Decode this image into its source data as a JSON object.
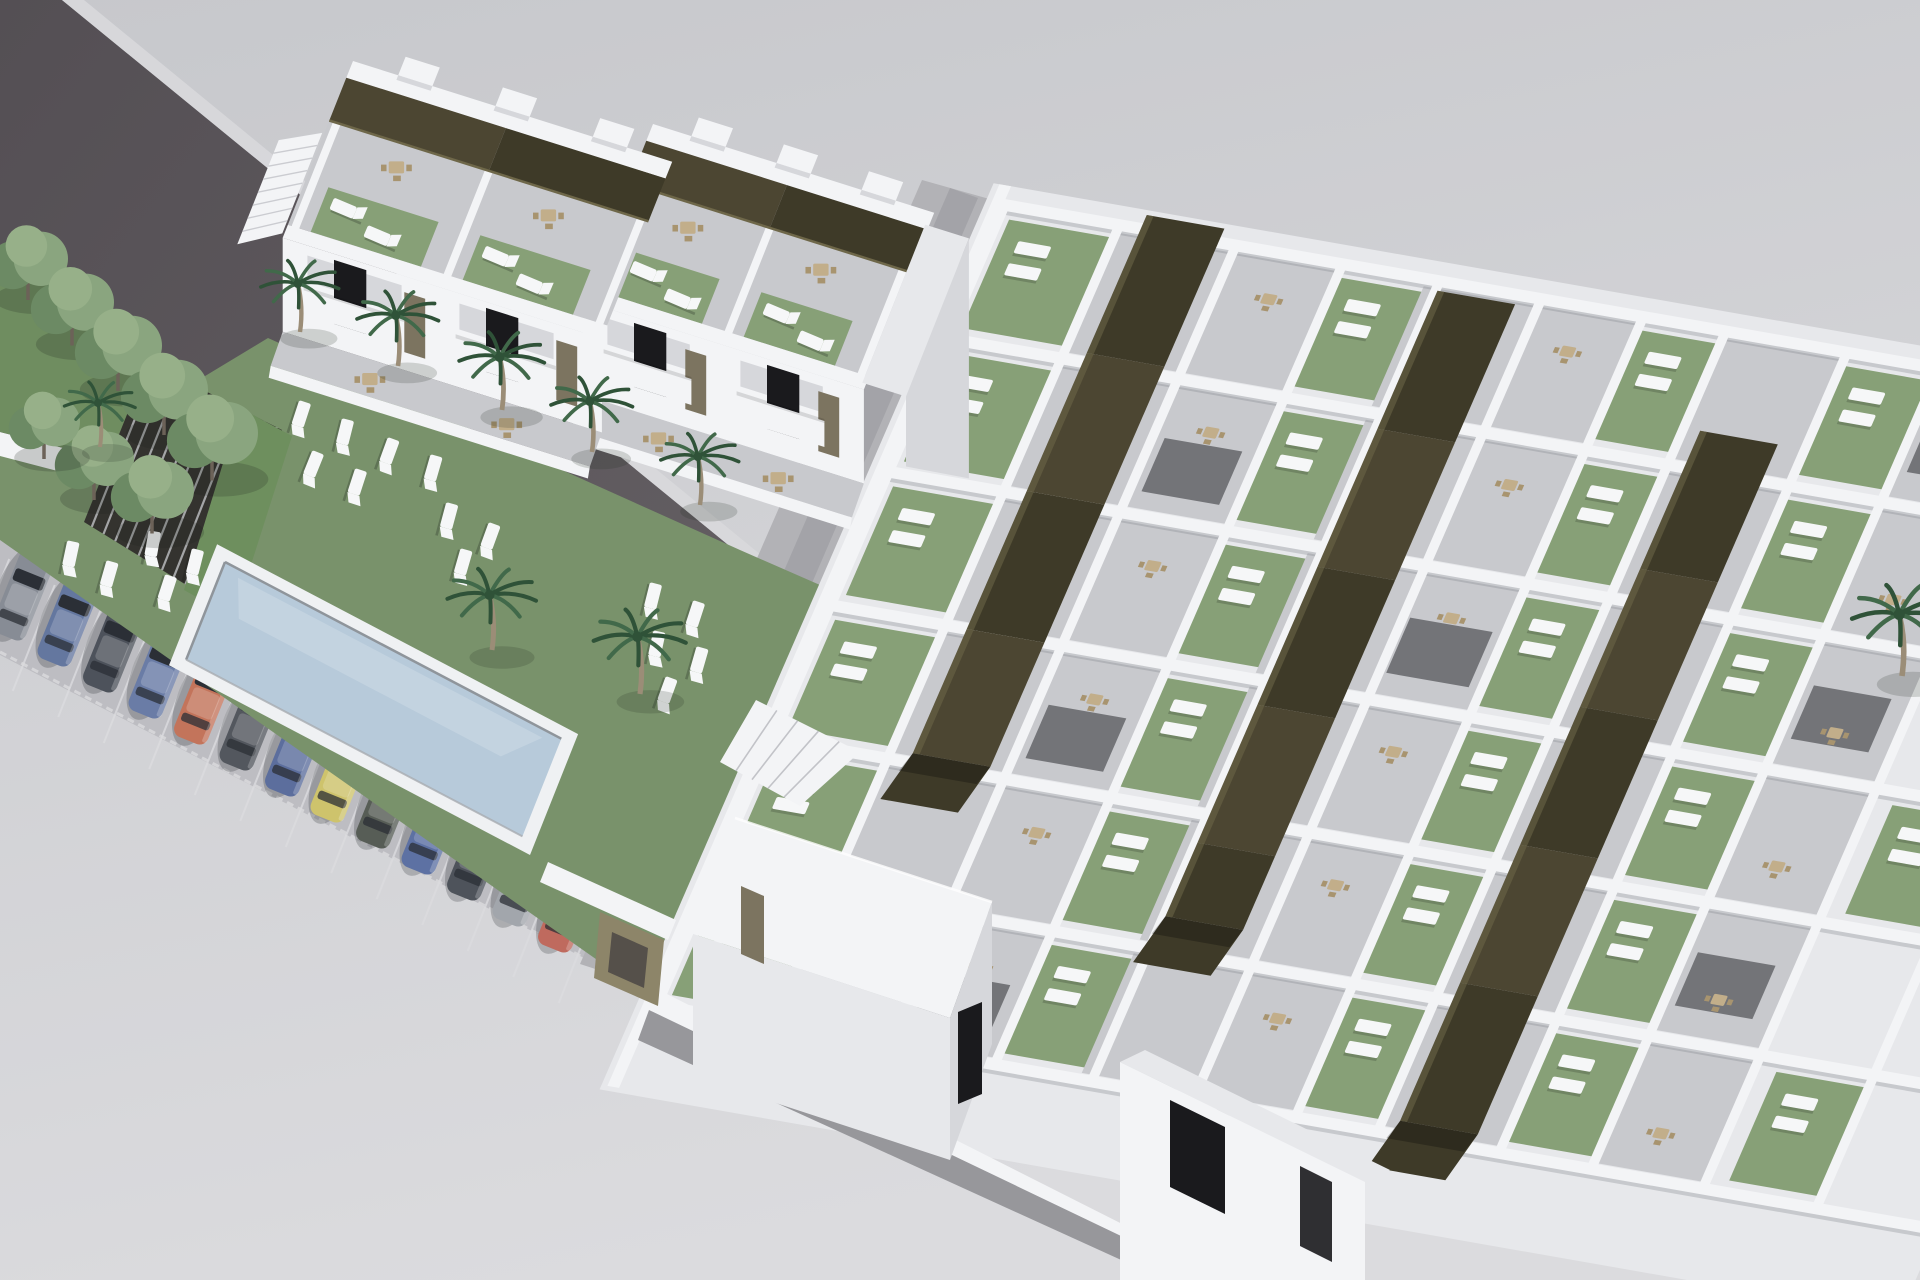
{
  "meta": {
    "title": "New-build residential complex – aerial 3D render"
  },
  "site": {
    "description": "Aerial 3D architectural rendering of a white residential development: two-storey townhouses with roof terraces and olive pergolas, a communal lawn with swimming pool, sun loungers and palm trees, a row of parked cars along a dark asphalt road, and a large single-storey bungalow complex with green roof gardens crossed by three long dark pergola strips.",
    "left_block": {
      "label": "two-storey townhouse block",
      "units": 4,
      "roof_terraces": 4,
      "roof_pergolas": 2,
      "staircases": 3
    },
    "garden": {
      "label": "communal garden",
      "swimming_pools": 1,
      "sun_loungers": 19,
      "palm_trees": 9,
      "deciduous_trees": 8
    },
    "parking": {
      "label": "street parking row",
      "car_colors": [
        "#878c95",
        "#64779f",
        "#4d525b",
        "#6a7ca6",
        "#c3745b",
        "#53575e",
        "#5c6e9d",
        "#cec36c",
        "#575d56",
        "#5d71a3",
        "#4e535b",
        "#a2a6ac",
        "#bf6a5e"
      ]
    },
    "right_block": {
      "label": "single-storey bungalow complex",
      "pergola_strips": 3,
      "unit_rows": 6,
      "roof_gardens": 22,
      "patios": 18
    }
  },
  "palette": {
    "bg_top": "#c7c8cc",
    "bg_bottom": "#dbdbde",
    "road": "#635e62",
    "road_dark": "#544f54",
    "curb": "#d8d8db",
    "pavement": "#bdbdc2",
    "stall_line": "#dcdcdf",
    "street": "#b2b2b6",
    "street_dark": "#a3a3a8",
    "walk_dark": "#97979b",
    "wall_white": "#f3f4f6",
    "wall_light": "#e7e8eb",
    "wall_shade": "#d6d7db",
    "wall_dark": "#c2c3c8",
    "terrace": "#c8c9cd",
    "courtyard": "#737478",
    "window_dark": "#1a1a1d",
    "door_olive": "#7c7460",
    "pergola_dark": "#3e3a28",
    "pergola_mid": "#4c4632",
    "pergola_light": "#6e6749",
    "lawn": "#79926b",
    "lawn_dark": "#6f8d60",
    "roof_garden": "#87a077",
    "hedge": "#6e8f5e",
    "shed_dark": "#34332f",
    "shed_slat": "#caccd0",
    "pool_water": "#b7cada",
    "pool_water_light": "#cddbe6",
    "pool_coping": "#eff1f3",
    "pool_lip": "#8f959b",
    "lounger": "#f6f7f8",
    "furniture": "#c2ae8a",
    "furniture_dark": "#a8946f",
    "palm_frond": "#41694a",
    "palm_frond_dark": "#2f5238",
    "palm_trunk": "#9b8d77",
    "tree_foliage": "#8aa57f",
    "tree_foliage_dark": "#6c8a64",
    "tree_foliage_light": "#97b089",
    "tree_trunk": "#6c6258",
    "car_glass": "#2b2f36",
    "khaki_wall": "#8d8569",
    "khaki_dark": "#55504a",
    "shadow": "rgba(25,28,32,0.22)"
  }
}
